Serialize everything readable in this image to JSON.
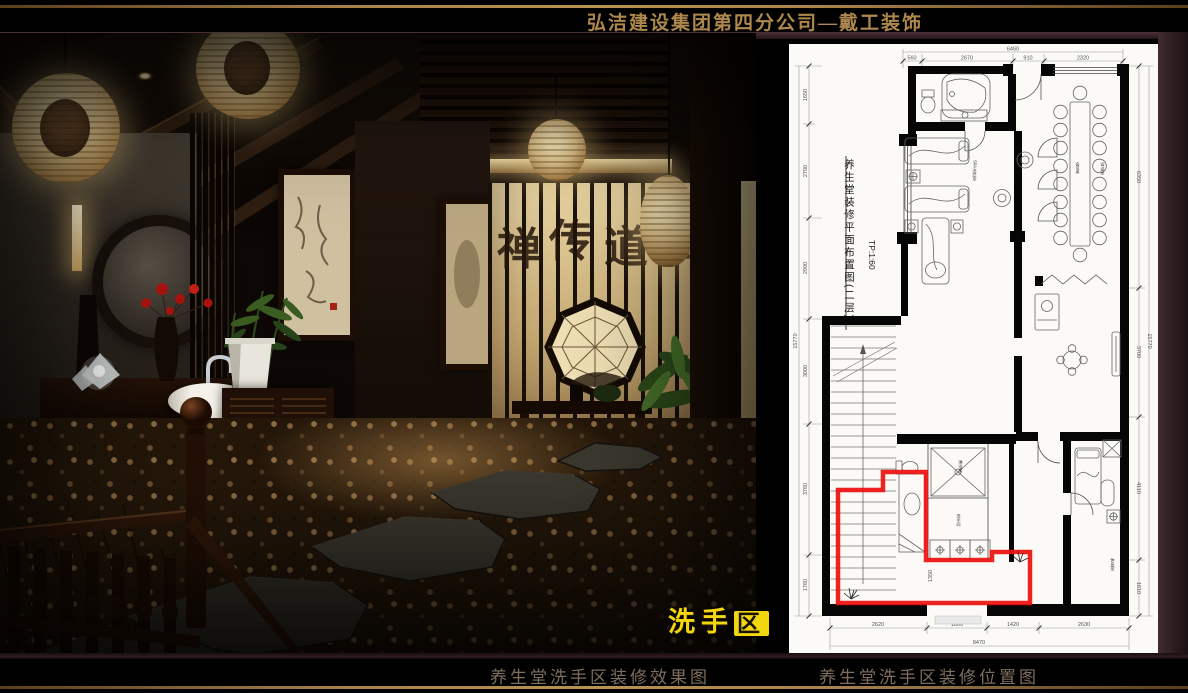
{
  "header": {
    "company_title": "弘洁建设集团第四分公司—戴工装饰"
  },
  "captions": {
    "left_photo": "养生堂洗手区装修效果图",
    "right_plan": "养生堂洗手区装修位置图"
  },
  "photo": {
    "area_label_prefix": "洗手",
    "area_label_boxed": "区",
    "screen_calligraphy": [
      "禅",
      "传",
      "道",
      "悟"
    ]
  },
  "floor_plan": {
    "title_vertical": "养生堂装修平面布置图(二层)",
    "scale_note": "TP:1:60",
    "rooms": {
      "spa": "SPA治疗室",
      "meeting": "会议室",
      "meeting_table": "会议桌",
      "rest": "休息室",
      "shower": "淋浴房",
      "washroom": "洗手间"
    },
    "dimensions": {
      "top": {
        "total": "6460",
        "segments": [
          "560",
          "2670",
          "910",
          "2320"
        ]
      },
      "bottom": {
        "total": "8470",
        "segments": [
          "2620",
          "1800",
          "1420",
          "2630"
        ]
      },
      "left": {
        "total": "15770",
        "segments": [
          "1650",
          "2700",
          "2900",
          "3000",
          "3760",
          "1760"
        ]
      },
      "right": {
        "total": "15770",
        "segments": [
          "6350",
          "3700",
          "4110",
          "1610"
        ]
      },
      "interior_stair": "1350"
    }
  },
  "colors": {
    "accent_gold": "#ae884c",
    "caption_text": "#7e6e5d",
    "plan_highlight_red": "#ee1111",
    "area_label_yellow": "#f2d60e"
  }
}
